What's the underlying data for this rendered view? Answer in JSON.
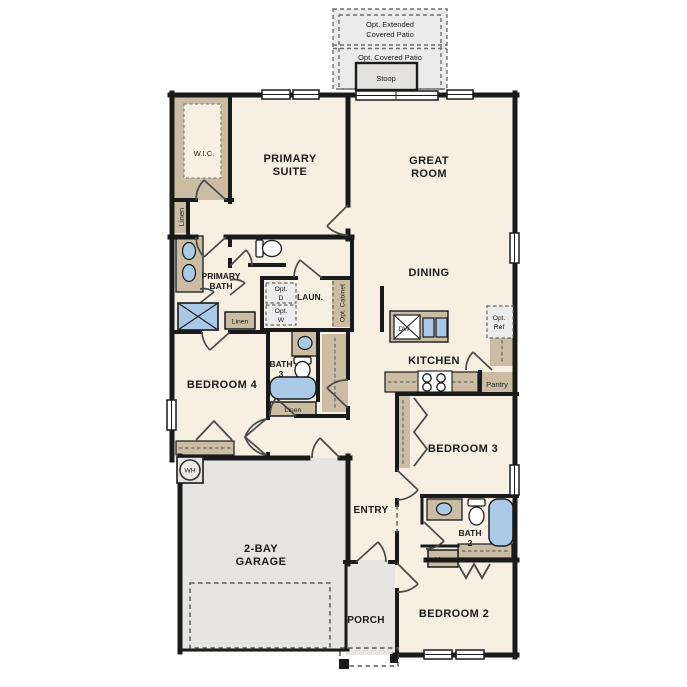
{
  "colors": {
    "floor": "#f6efe2",
    "wall": "#1a1a1a",
    "cabinet": "#cbbda3",
    "concrete": "#e6e5e3",
    "fixture_blue": "#a9c9e6"
  },
  "outdoor": {
    "patio_ext": [
      "Opt. Extended",
      "Covered Patio"
    ],
    "patio_cov": "Opt. Covered Patio",
    "stoop": "Stoop",
    "porch": "PORCH",
    "garage": [
      "2-BAY",
      "GARAGE"
    ]
  },
  "rooms": {
    "wic": "W.I.C.",
    "primary_suite": [
      "PRIMARY",
      "SUITE"
    ],
    "great_room": [
      "GREAT",
      "ROOM"
    ],
    "dining": "DINING",
    "primary_bath": [
      "PRIMARY",
      "BATH"
    ],
    "laundry": "LAUN.",
    "bath3": [
      "BATH",
      "3"
    ],
    "bedroom4": "BEDROOM 4",
    "kitchen": "KITCHEN",
    "bedroom3": "BEDROOM 3",
    "entry": "ENTRY",
    "bath2": [
      "BATH",
      "2"
    ],
    "bedroom2": "BEDROOM 2"
  },
  "closets": {
    "linen_hall": "Linen",
    "linen_primary": "Linen",
    "linen_bath3": "Linen",
    "linen_bath2": "Linen",
    "pantry": "Pantry"
  },
  "appliances": {
    "opt_dryer": [
      "Opt.",
      "D"
    ],
    "opt_washer": [
      "Opt.",
      "W"
    ],
    "opt_cabinet": "Opt. Cabinet",
    "opt_ref": [
      "Opt.",
      "Ref"
    ],
    "dishwasher": "DW",
    "water_heater": "WH"
  }
}
